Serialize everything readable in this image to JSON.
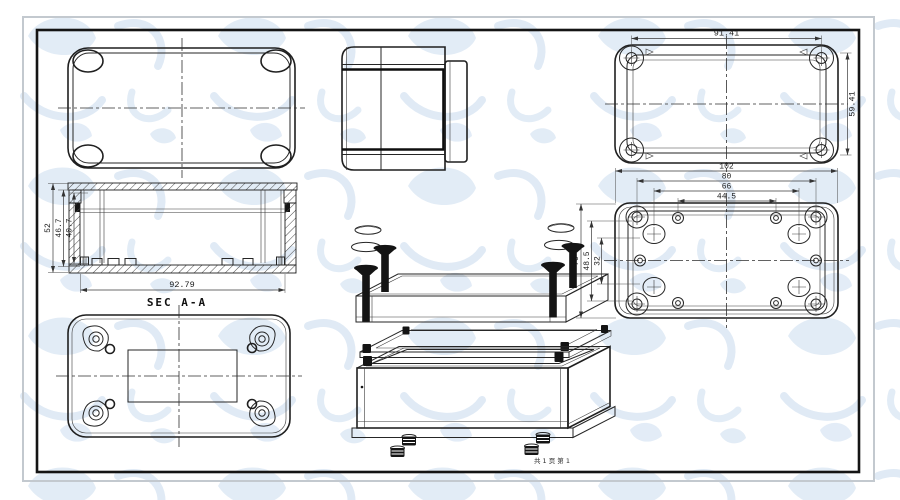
{
  "sheet": {
    "page_note": "共 1 页 第 1",
    "colors": {
      "line": "#1f1f1f",
      "dimension_text": "#1c1c1c",
      "watermark": "#d8e5f3",
      "frame_outer_gray": "#c3c9cf",
      "frame_inner_black": "#141414",
      "paper": "#ffffff"
    }
  },
  "views": {
    "lid_inside": {
      "dims": {
        "width": "91.41",
        "height": "59.41"
      }
    },
    "base_inside": {
      "dims": {
        "overall_width": "102",
        "screw_span": "80",
        "boss_span": "66",
        "hole_span": "44.5",
        "overall_height": "70",
        "screw_span_v": "48.5",
        "boss_span_v": "32"
      }
    },
    "section": {
      "label": "SEC A-A",
      "dims": {
        "overall_height": "52",
        "inner_height": "46.7",
        "cavity_height": "40.7",
        "inner_width": "92.79"
      }
    }
  }
}
